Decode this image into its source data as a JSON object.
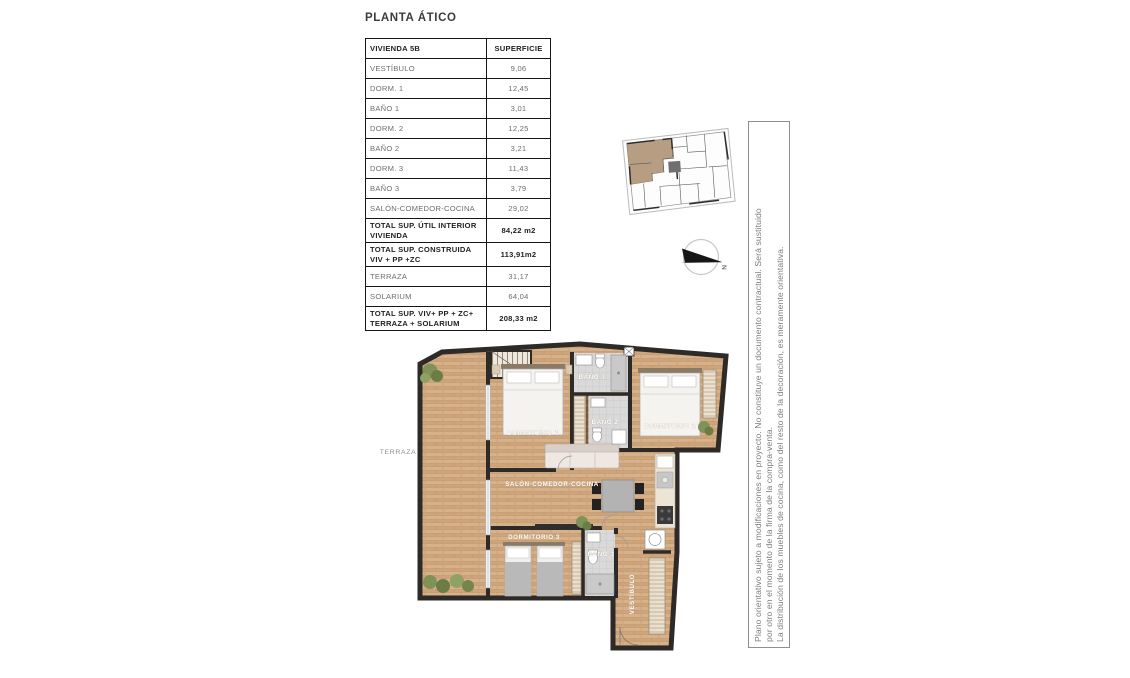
{
  "title": "PLANTA ÁTICO",
  "table": {
    "header": {
      "col1": "VIVIENDA 5B",
      "col2": "SUPERFICIE"
    },
    "rows": [
      {
        "label": "VESTÍBULO",
        "value": "9,06",
        "bold": false
      },
      {
        "label": "DORM. 1",
        "value": "12,45",
        "bold": false
      },
      {
        "label": "BAÑO 1",
        "value": "3,01",
        "bold": false
      },
      {
        "label": "DORM. 2",
        "value": "12,25",
        "bold": false
      },
      {
        "label": "BAÑO 2",
        "value": "3,21",
        "bold": false
      },
      {
        "label": "DORM. 3",
        "value": "11,43",
        "bold": false
      },
      {
        "label": "BAÑO 3",
        "value": "3,79",
        "bold": false
      },
      {
        "label": "SALÓN-COMEDOR-COCINA",
        "value": "29,02",
        "bold": false
      },
      {
        "label": "TOTAL SUP. ÚTIL INTERIOR VIVIENDA",
        "value": "84,22 m2",
        "bold": true
      },
      {
        "label": "TOTAL SUP. CONSTRUIDA VIV + PP +ZC",
        "value": "113,91m2",
        "bold": true
      },
      {
        "label": "TERRAZA",
        "value": "31,17",
        "bold": false
      },
      {
        "label": "SOLARIUM",
        "value": "64,04",
        "bold": false
      },
      {
        "label": "TOTAL SUP. VIV+ PP + ZC+ TERRAZA + SOLARIUM",
        "value": "208,33 m2",
        "bold": true
      }
    ]
  },
  "plan": {
    "labels": {
      "terraza": "TERRAZA",
      "dorm1": "DORMITORIO 1",
      "bano1": "BAÑO 1",
      "bano2": "BAÑO 2",
      "dorm2": "DORMITORIO 2",
      "salon": "SALÓN-COMEDOR-COCINA",
      "dorm3": "DORMITORIO 3",
      "bano3": "BAÑO 3",
      "vestibulo": "VESTÍBULO"
    }
  },
  "compass": {
    "north": "N"
  },
  "disclaimer": {
    "lines": [
      "Plano orientativo sujeto a modificaciones en proyecto. No constituye un documento contractual. Será sustituido",
      "por otro en el momento de la firma de la compra-venta.",
      "La distribución de los muebles de cocina, como del resto de la decoración, es meramente orientativa."
    ]
  },
  "colors": {
    "wall": "#2d2a27",
    "wood": "#cda47b",
    "wood_light": "#d7b189",
    "tile": "#d9d9d9",
    "highlight_unit": "#b79e82",
    "table_border": "#161616",
    "muted_text": "#7d7d7d"
  }
}
